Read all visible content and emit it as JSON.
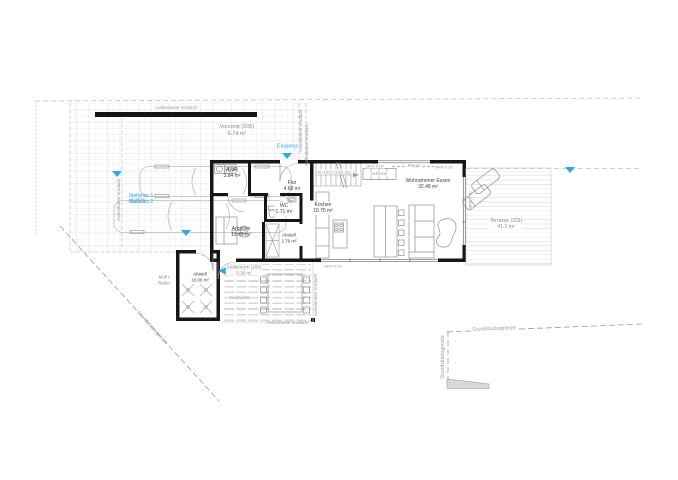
{
  "document": {
    "type": "architectural floor plan",
    "background": "#ffffff"
  },
  "colors": {
    "accent_blue": "#29abe2",
    "wall_black": "#161616",
    "furniture_gray": "#8f8f8f",
    "boundary_gray": "#9b9b9b"
  },
  "rooms": {
    "awr": {
      "name": "AWR",
      "area": "3.84 m²"
    },
    "flur": {
      "name": "Flur",
      "area": "4.68 m²"
    },
    "wc": {
      "name": "WC",
      "area": "1.71 m²"
    },
    "arbeiten": {
      "name": "Arbeiten",
      "area": "13.49 m²"
    },
    "abstell": {
      "name": "Abstell",
      "area": "2.79 m²"
    },
    "kochen": {
      "name": "Kochen",
      "area": "10.75 m²"
    },
    "wohnzimmer_essen": {
      "name": "Wohnzimmer Essen",
      "area": "32.48 m²"
    },
    "abstell_garten": {
      "name": "Abstell",
      "area": "10.00 m²"
    }
  },
  "outdoor": {
    "vorzone": {
      "name": "Vorzone (205)",
      "area": "6.74 m²"
    },
    "suedbereich": {
      "name": "Südbereich (205)",
      "area": "5.36 m²"
    },
    "terrasse": {
      "name": "Terrasse (229)",
      "area": "41.1 m²"
    },
    "kiesboden": "Kiesboden",
    "muell_line1": "Müll /",
    "muell_line2": "Räder"
  },
  "markers": {
    "eingang": "Eingang",
    "stellplatz_1": "Stellplatz 1",
    "stellplatz_2": "Stellplatz 2"
  },
  "annotations": {
    "aussenkante_vordach": "Außenkante Vordach",
    "grundstuecksgrenze": "Grundstücksgrenze",
    "schrank": "Schrank",
    "riegel": "Riegel",
    "brh_000": "BRH 0.00",
    "brh_035": "BRH 0.35",
    "brh_090": "BRH 0.90",
    "stair_note": "Au 18x17,5/29 Stg"
  }
}
